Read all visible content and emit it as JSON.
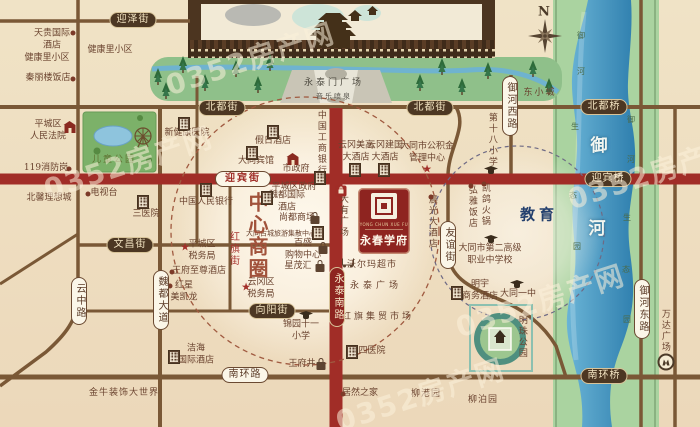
{
  "watermark": {
    "text": "0352房产网",
    "spots": [
      {
        "x": 250,
        "y": 58
      },
      {
        "x": 128,
        "y": 162
      },
      {
        "x": 420,
        "y": 394
      },
      {
        "x": 652,
        "y": 172
      },
      {
        "x": 540,
        "y": 300
      }
    ]
  },
  "compass_label": "N",
  "project": {
    "name": "永春学府",
    "latin": "YONG CHUN XUE FU"
  },
  "zones": {
    "cbd": "中心商圈",
    "education": "教育"
  },
  "plaza": {
    "name": "永泰门广场",
    "sub": "音乐喷泉"
  },
  "colors": {
    "road_red": "#a12d27",
    "road_brown": "#7a5836",
    "badge_dark": "#4c3723",
    "river": "#2f7fae",
    "accent_red": "#8e2420"
  },
  "streets": [
    {
      "t": "迎泽街",
      "x": 133,
      "y": 20,
      "k": "dark"
    },
    {
      "t": "北都街",
      "x": 222,
      "y": 108,
      "k": "dark"
    },
    {
      "t": "北都街",
      "x": 430,
      "y": 108,
      "k": "dark"
    },
    {
      "t": "北都桥",
      "x": 604,
      "y": 107,
      "k": "dark"
    },
    {
      "t": "文昌街",
      "x": 130,
      "y": 245,
      "k": "dark"
    },
    {
      "t": "向阳街",
      "x": 272,
      "y": 311,
      "k": "dark"
    },
    {
      "t": "迎宾桥",
      "x": 608,
      "y": 179,
      "k": "dark"
    },
    {
      "t": "南环桥",
      "x": 604,
      "y": 376,
      "k": "dark"
    },
    {
      "t": "迎宾街",
      "x": 243,
      "y": 179,
      "k": "lightred"
    },
    {
      "t": "南环路",
      "x": 245,
      "y": 375,
      "k": "light"
    },
    {
      "t": "云中路",
      "x": 79,
      "y": 301,
      "k": "light",
      "v": 1
    },
    {
      "t": "魏都大道",
      "x": 161,
      "y": 300,
      "k": "light",
      "v": 1
    },
    {
      "t": "友谊街",
      "x": 448,
      "y": 245,
      "k": "light",
      "v": 1
    },
    {
      "t": "御河西路",
      "x": 510,
      "y": 106,
      "k": "light",
      "v": 1
    },
    {
      "t": "御河东路",
      "x": 642,
      "y": 309,
      "k": "light",
      "v": 1
    },
    {
      "t": "永泰南路",
      "x": 337,
      "y": 297,
      "k": "red",
      "v": 1
    }
  ],
  "labels": [
    {
      "t": "N",
      "x": 544,
      "y": 13,
      "s": "compass",
      "n": "compass-north-label"
    },
    {
      "t": "东小城",
      "x": 540,
      "y": 94,
      "ls": 2
    },
    {
      "t": "天贵国际\n酒店",
      "x": 52,
      "y": 40
    },
    {
      "t": "健康里小区",
      "x": 47,
      "y": 59
    },
    {
      "t": "秦丽楼饭店",
      "x": 48,
      "y": 79
    },
    {
      "t": "健康里小区",
      "x": 110,
      "y": 51
    },
    {
      "t": "平城区\n人民法院",
      "x": 48,
      "y": 131
    },
    {
      "t": "119消防岗",
      "x": 46,
      "y": 169
    },
    {
      "t": "儿童公园",
      "x": 114,
      "y": 161,
      "s": "green",
      "n": "park-label"
    },
    {
      "t": "北馨理想城",
      "x": 49,
      "y": 199
    },
    {
      "t": "电视台",
      "x": 104,
      "y": 194
    },
    {
      "t": "三医院",
      "x": 146,
      "y": 215
    },
    {
      "t": "新健康医院",
      "x": 187,
      "y": 134
    },
    {
      "t": "假日酒店",
      "x": 273,
      "y": 142
    },
    {
      "t": "大同宾馆",
      "x": 256,
      "y": 162
    },
    {
      "t": "市政府",
      "x": 296,
      "y": 170
    },
    {
      "t": "中国人民银行",
      "x": 206,
      "y": 203
    },
    {
      "t": "中国工商银行",
      "x": 320,
      "y": 143,
      "v": 1
    },
    {
      "t": "云冈美高\n大酒店",
      "x": 356,
      "y": 152
    },
    {
      "t": "云冈建国\n大酒店",
      "x": 385,
      "y": 152
    },
    {
      "t": "大同市公积金\n管理中心",
      "x": 427,
      "y": 153
    },
    {
      "t": "第十八小学",
      "x": 491,
      "y": 140,
      "v": 1
    },
    {
      "t": "平城区政府",
      "x": 294,
      "y": 188
    },
    {
      "t": "魏都国际\n酒店",
      "x": 287,
      "y": 202
    },
    {
      "t": "尚都商场",
      "x": 297,
      "y": 219
    },
    {
      "t": "大同古城旅游集散中心",
      "x": 281,
      "y": 234,
      "s": "tiny"
    },
    {
      "t": "百盛\n购物中心",
      "x": 303,
      "y": 250
    },
    {
      "t": "星茂汇",
      "x": 298,
      "y": 267
    },
    {
      "t": "沃尔玛超市",
      "x": 372,
      "y": 266,
      "ls": 1
    },
    {
      "t": "永泰广场",
      "x": 376,
      "y": 287,
      "ls": 4
    },
    {
      "t": "红旗集贸市场",
      "x": 378,
      "y": 318,
      "ls": 3
    },
    {
      "t": "弘雅饭店",
      "x": 471,
      "y": 207,
      "v": 1
    },
    {
      "t": "凯鸽火锅",
      "x": 484,
      "y": 205,
      "v": 1
    },
    {
      "t": "晨光大酒店",
      "x": 431,
      "y": 222,
      "v": 1
    },
    {
      "t": "王府至尊酒店",
      "x": 199,
      "y": 272
    },
    {
      "t": "红星\n美凯龙",
      "x": 184,
      "y": 292
    },
    {
      "t": "云冈区\n税务局",
      "x": 261,
      "y": 289
    },
    {
      "t": "平城区\n税务局",
      "x": 202,
      "y": 251
    },
    {
      "t": "锦园十一\n小学",
      "x": 301,
      "y": 331
    },
    {
      "t": "四医院",
      "x": 372,
      "y": 352
    },
    {
      "t": "王府井",
      "x": 302,
      "y": 365
    },
    {
      "t": "居然之家",
      "x": 360,
      "y": 394
    },
    {
      "t": "柳港园",
      "x": 426,
      "y": 395,
      "ls": 1
    },
    {
      "t": "柳泊园",
      "x": 483,
      "y": 401,
      "ls": 1
    },
    {
      "t": "洁海\n国际酒店",
      "x": 196,
      "y": 355
    },
    {
      "t": "金牛装饰大世界",
      "x": 124,
      "y": 394,
      "ls": 1
    },
    {
      "t": "明宇\n商务酒店",
      "x": 480,
      "y": 291
    },
    {
      "t": "大同市第二高级\n职业中学校",
      "x": 490,
      "y": 255
    },
    {
      "t": "大同一中",
      "x": 518,
      "y": 295
    },
    {
      "t": "明珠公园",
      "x": 521,
      "y": 337,
      "v": 1,
      "n": "park-label"
    },
    {
      "t": "万达广场",
      "x": 664,
      "y": 331,
      "v": 1
    },
    {
      "t": "大有广场",
      "x": 342,
      "y": 216,
      "v": 1
    },
    {
      "t": "红旗街",
      "x": 233,
      "y": 249,
      "v": 1,
      "s": "redv",
      "n": "street-name"
    },
    {
      "t": "中心商圈",
      "x": 257,
      "y": 236,
      "v": 1,
      "s": "big",
      "n": "zone-cbd-label"
    },
    {
      "t": "教育",
      "x": 539,
      "y": 215,
      "s": "edu",
      "ls": 4,
      "n": "zone-education-label"
    },
    {
      "t": "永泰门广场",
      "x": 334,
      "y": 84,
      "s": "plaza"
    },
    {
      "t": "音乐喷泉",
      "x": 334,
      "y": 97,
      "s": "psub"
    },
    {
      "t": "御",
      "x": 599,
      "y": 146,
      "s": "rb",
      "n": "river-name"
    },
    {
      "t": "河",
      "x": 597,
      "y": 229,
      "s": "rb",
      "n": "river-name"
    },
    {
      "t": "御",
      "x": 581,
      "y": 36,
      "s": "bank"
    },
    {
      "t": "河",
      "x": 581,
      "y": 72,
      "s": "bank"
    },
    {
      "t": "生",
      "x": 575,
      "y": 127,
      "s": "bank"
    },
    {
      "t": "态",
      "x": 573,
      "y": 196,
      "s": "bank"
    },
    {
      "t": "园",
      "x": 577,
      "y": 247,
      "s": "bank"
    },
    {
      "t": "御",
      "x": 631,
      "y": 120,
      "s": "bank"
    },
    {
      "t": "河",
      "x": 631,
      "y": 160,
      "s": "bank"
    },
    {
      "t": "生",
      "x": 627,
      "y": 218,
      "s": "bank"
    },
    {
      "t": "态",
      "x": 626,
      "y": 270,
      "s": "bank"
    },
    {
      "t": "园",
      "x": 627,
      "y": 320,
      "s": "bank"
    }
  ],
  "icons": [
    {
      "k": "dot",
      "x": 73,
      "y": 33
    },
    {
      "k": "dot",
      "x": 73,
      "y": 79
    },
    {
      "k": "dot",
      "x": 69,
      "y": 169
    },
    {
      "k": "dot",
      "x": 88,
      "y": 194
    },
    {
      "k": "gov",
      "x": 70,
      "y": 129
    },
    {
      "k": "building",
      "x": 143,
      "y": 202
    },
    {
      "k": "building",
      "x": 206,
      "y": 190
    },
    {
      "k": "building",
      "x": 184,
      "y": 124
    },
    {
      "k": "building",
      "x": 273,
      "y": 132
    },
    {
      "k": "building",
      "x": 252,
      "y": 153
    },
    {
      "k": "gov",
      "x": 293,
      "y": 161
    },
    {
      "k": "building",
      "x": 320,
      "y": 178
    },
    {
      "k": "building",
      "x": 355,
      "y": 170
    },
    {
      "k": "building",
      "x": 384,
      "y": 170
    },
    {
      "k": "star",
      "x": 427,
      "y": 169
    },
    {
      "k": "school",
      "x": 491,
      "y": 170
    },
    {
      "k": "building",
      "x": 267,
      "y": 198
    },
    {
      "k": "bag",
      "x": 315,
      "y": 217
    },
    {
      "k": "building",
      "x": 318,
      "y": 233
    },
    {
      "k": "bag",
      "x": 323,
      "y": 247
    },
    {
      "k": "bag",
      "x": 320,
      "y": 265
    },
    {
      "k": "cart",
      "x": 348,
      "y": 264
    },
    {
      "k": "dot",
      "x": 471,
      "y": 186
    },
    {
      "k": "dot",
      "x": 484,
      "y": 184
    },
    {
      "k": "dot",
      "x": 431,
      "y": 197
    },
    {
      "k": "dot",
      "x": 172,
      "y": 272
    },
    {
      "k": "dot",
      "x": 170,
      "y": 286
    },
    {
      "k": "star",
      "x": 246,
      "y": 287
    },
    {
      "k": "star",
      "x": 185,
      "y": 247
    },
    {
      "k": "school",
      "x": 306,
      "y": 315
    },
    {
      "k": "building",
      "x": 352,
      "y": 352
    },
    {
      "k": "bag",
      "x": 321,
      "y": 363
    },
    {
      "k": "dot",
      "x": 343,
      "y": 394
    },
    {
      "k": "building",
      "x": 174,
      "y": 357
    },
    {
      "k": "building",
      "x": 457,
      "y": 293
    },
    {
      "k": "school",
      "x": 491,
      "y": 239
    },
    {
      "k": "school",
      "x": 517,
      "y": 284
    },
    {
      "k": "shopred",
      "x": 341,
      "y": 191
    },
    {
      "k": "wanda",
      "x": 666,
      "y": 362
    }
  ]
}
